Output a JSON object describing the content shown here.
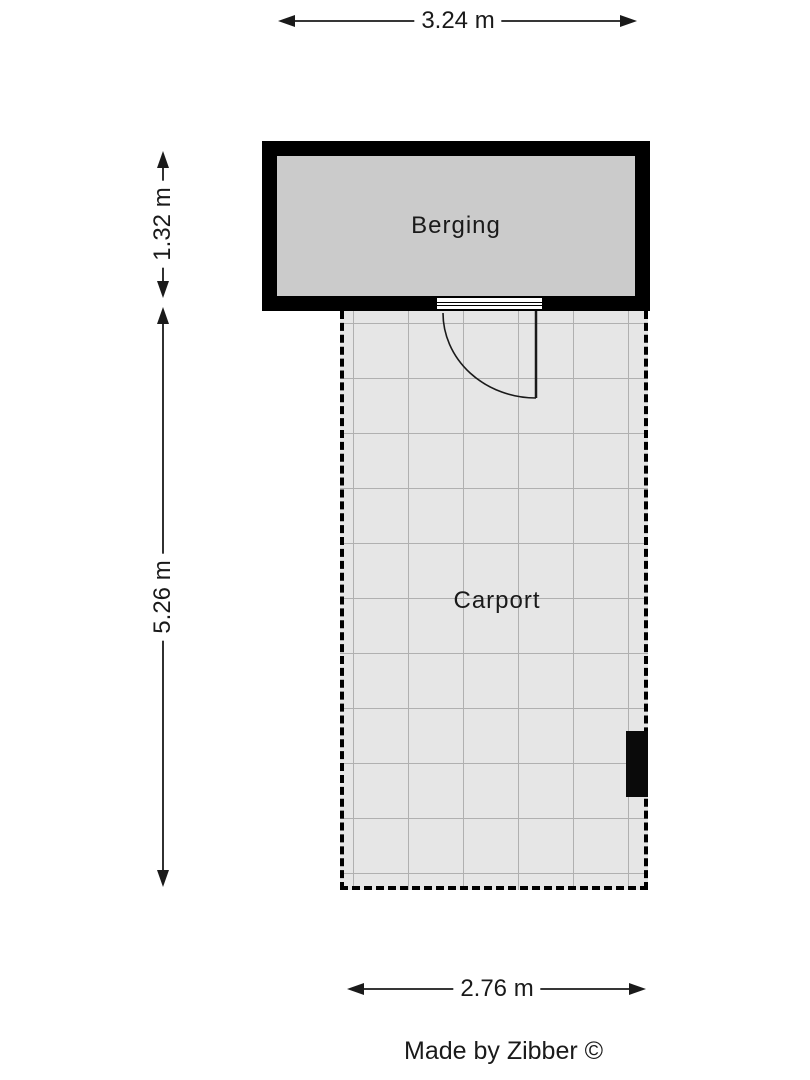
{
  "page": {
    "background_color": "#ffffff",
    "type": "floorplan"
  },
  "floorplan": {
    "rooms": [
      {
        "id": "berging",
        "label": "Berging",
        "fill_color": "#cbcbcb",
        "wall_color": "#000000",
        "wall_style": "solid-thick"
      },
      {
        "id": "carport",
        "label": "Carport",
        "fill_color": "#e6e6e6",
        "grid_color": "#b0b0b0",
        "border_color": "#000000",
        "border_style": "dashed"
      }
    ],
    "dimensions": [
      {
        "id": "top",
        "label": "3.24 m",
        "value_m": 3.24,
        "orientation": "horizontal",
        "measures": "berging width"
      },
      {
        "id": "left-upper",
        "label": "1.32 m",
        "value_m": 1.32,
        "orientation": "vertical",
        "measures": "berging depth"
      },
      {
        "id": "left-lower",
        "label": "5.26 m",
        "value_m": 5.26,
        "orientation": "vertical",
        "measures": "carport depth"
      },
      {
        "id": "bottom",
        "label": "2.76 m",
        "value_m": 2.76,
        "orientation": "horizontal",
        "measures": "carport width"
      }
    ],
    "features": [
      {
        "id": "door",
        "type": "door-swing",
        "location": "berging bottom wall, opens into carport"
      },
      {
        "id": "post",
        "type": "black-rectangle",
        "location": "carport right edge"
      }
    ]
  },
  "footer": {
    "credit": "Made by Zibber ©"
  }
}
